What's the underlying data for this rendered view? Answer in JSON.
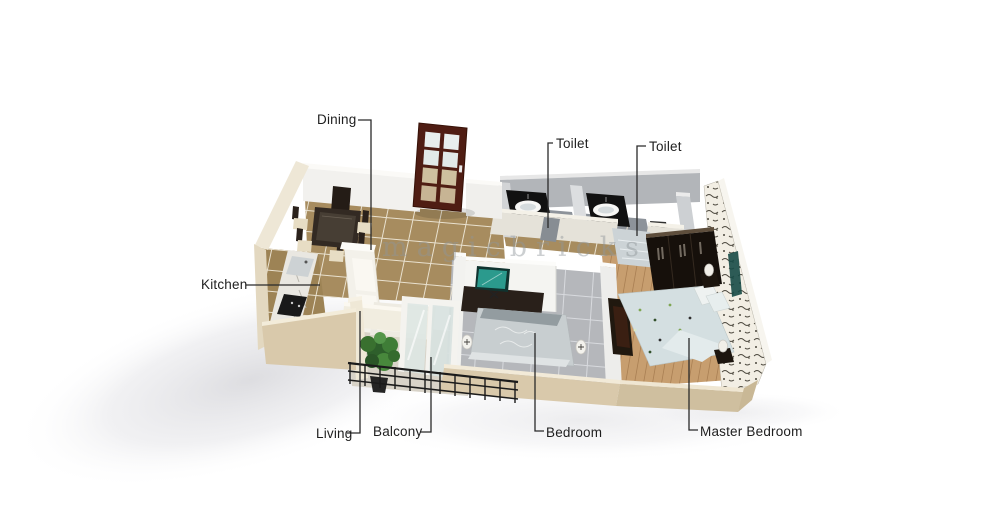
{
  "watermark": {
    "text": "magicbricks"
  },
  "floor_plan": {
    "type": "3d-isometric-floor-plan",
    "rooms": [
      {
        "id": "dining",
        "label": "Dining"
      },
      {
        "id": "toilet-1",
        "label": "Toilet"
      },
      {
        "id": "toilet-2",
        "label": "Toilet"
      },
      {
        "id": "kitchen",
        "label": "Kitchen"
      },
      {
        "id": "living",
        "label": "Living"
      },
      {
        "id": "balcony",
        "label": "Balcony"
      },
      {
        "id": "bedroom",
        "label": "Bedroom"
      },
      {
        "id": "master-bedroom",
        "label": "Master Bedroom"
      }
    ]
  },
  "colors": {
    "background": "#ffffff",
    "exterior_wall": "#d9c9ab",
    "interior_wall": "#f2f1ee",
    "floor_tile_tan": "#a78c5f",
    "floor_tile_grey": "#b5b7bb",
    "floor_wood": "#c79e6f",
    "entrance_door": "#4f1d13",
    "tv_screen": "#2b9a8d",
    "label_text": "#1e1e1e"
  }
}
